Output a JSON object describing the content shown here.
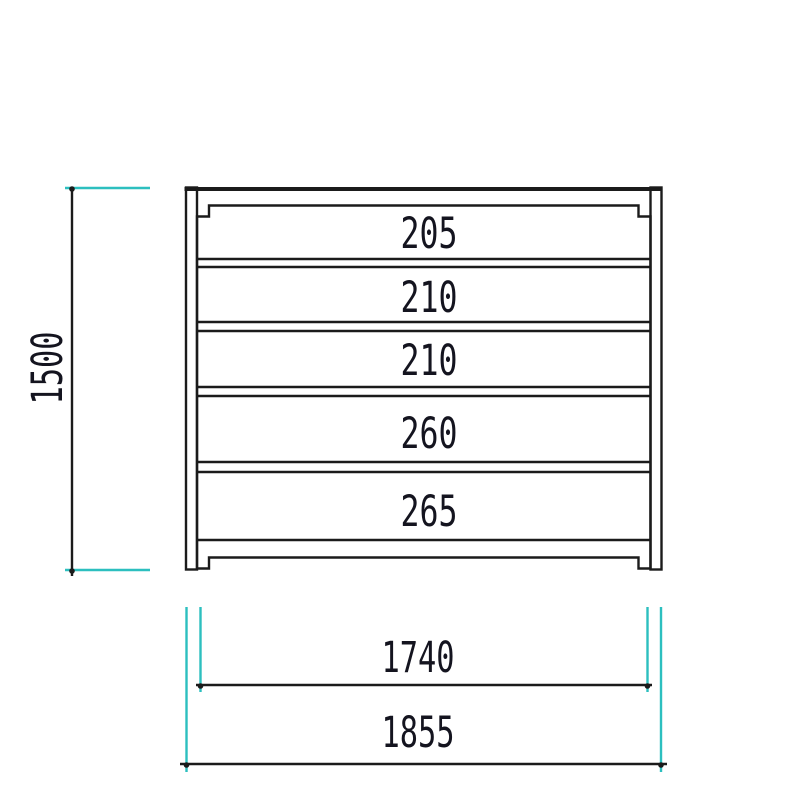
{
  "drawing": {
    "colors": {
      "outline": "#1b1b1b",
      "dimension": "#2cbfbf",
      "text": "#14141f",
      "background": "#ffffff"
    },
    "frame": {
      "rows": [
        {
          "label": "205"
        },
        {
          "label": "210"
        },
        {
          "label": "210"
        },
        {
          "label": "260"
        },
        {
          "label": "265"
        }
      ]
    },
    "dimensions": {
      "overall_height": {
        "label": "1500"
      },
      "inner_width": {
        "label": "1740"
      },
      "overall_width": {
        "label": "1855"
      }
    }
  }
}
